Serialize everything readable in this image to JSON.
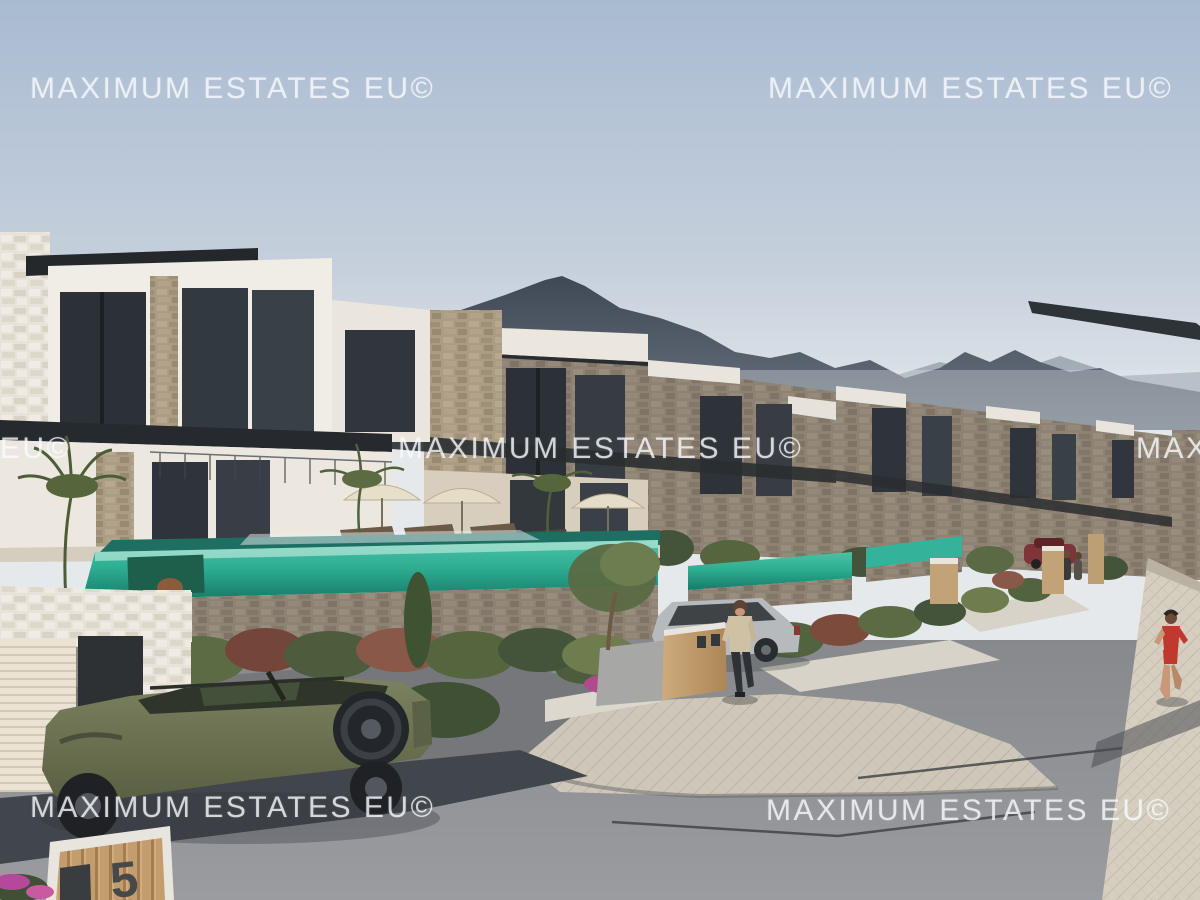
{
  "watermark": {
    "text": "MAXIMUM ESTATES EU©"
  },
  "gate_sign": {
    "number": "5"
  },
  "colors": {
    "sky_top": "#a9bbd1",
    "sky_horizon": "#e2e6ea",
    "mountain": "#46505c",
    "mountain_haze": "#99a3af",
    "villa_white": "#f0ede6",
    "stone_facade": "#8d8273",
    "stone_tan": "#ab9c84",
    "dark_trim": "#26292d",
    "pool_teal": "#2fae92",
    "pool_deep": "#177a68",
    "road_gray": "#8d8f93",
    "road_dark_band": "#41454c",
    "paver_light": "#cfc8ba",
    "sidewalk": "#d6cfc1",
    "foliage_green": "#51633f",
    "foliage_red": "#7d4b3c",
    "suv_olive": "#6e7452",
    "gate_wood": "#c09a6a",
    "watermark_white": "#f8fbff"
  }
}
